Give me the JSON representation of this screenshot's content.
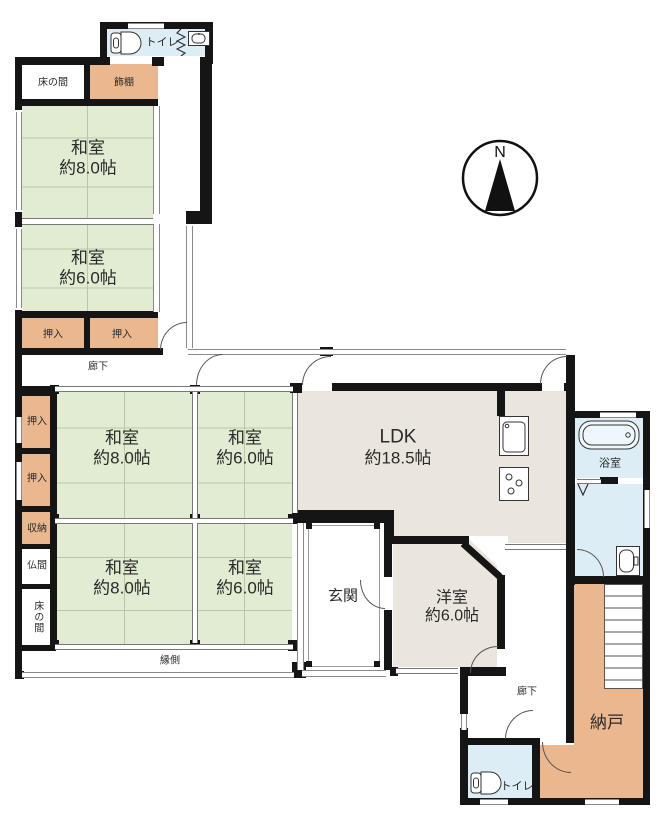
{
  "compass": {
    "north_label": "N"
  },
  "rooms": {
    "toilet_top": {
      "label": "トイレ"
    },
    "tokonoma_top": {
      "label": "床の間"
    },
    "kazaridana": {
      "label": "飾棚"
    },
    "washitsu_nw_8": {
      "label": "和室",
      "size": "約8.0帖"
    },
    "washitsu_nw_6": {
      "label": "和室",
      "size": "約6.0帖"
    },
    "oshiire_nw_left": {
      "label": "押入"
    },
    "oshiire_nw_right": {
      "label": "押入"
    },
    "rouka_upper": {
      "label": "廊下"
    },
    "oshiire_mid_1": {
      "label": "押入"
    },
    "oshiire_mid_2": {
      "label": "押入"
    },
    "shuno": {
      "label": "収納"
    },
    "butsuma": {
      "label": "仏間"
    },
    "tokonoma_mid": {
      "label": "床の間"
    },
    "washitsu_c_8": {
      "label": "和室",
      "size": "約8.0帖"
    },
    "washitsu_c_6": {
      "label": "和室",
      "size": "約6.0帖"
    },
    "washitsu_s_8": {
      "label": "和室",
      "size": "約8.0帖"
    },
    "washitsu_s_6": {
      "label": "和室",
      "size": "約6.0帖"
    },
    "ldk": {
      "label": "LDK",
      "size": "約18.5帖"
    },
    "yokushitsu": {
      "label": "浴室"
    },
    "genkan": {
      "label": "玄関"
    },
    "youshitsu": {
      "label": "洋室",
      "size": "約6.0帖"
    },
    "engawa": {
      "label": "縁側"
    },
    "rouka_lower": {
      "label": "廊下"
    },
    "nando": {
      "label": "納戸"
    },
    "toilet_bottom": {
      "label": "トイレ"
    }
  },
  "icons": [
    "toilet-icon",
    "hand-basin-icon",
    "accordion-door-icon",
    "bathtub-icon",
    "kitchen-sink-icon",
    "stove-icon",
    "washbasin-icon",
    "stairs-icon",
    "compass-north-icon",
    "folding-door-icon"
  ],
  "colors": {
    "tatami_green": "#e1ecd3",
    "closet_tan": "#eab78e",
    "water_blue": "#dcedf5",
    "ldk_beige": "#eae6dd",
    "wall_black": "#151515"
  }
}
